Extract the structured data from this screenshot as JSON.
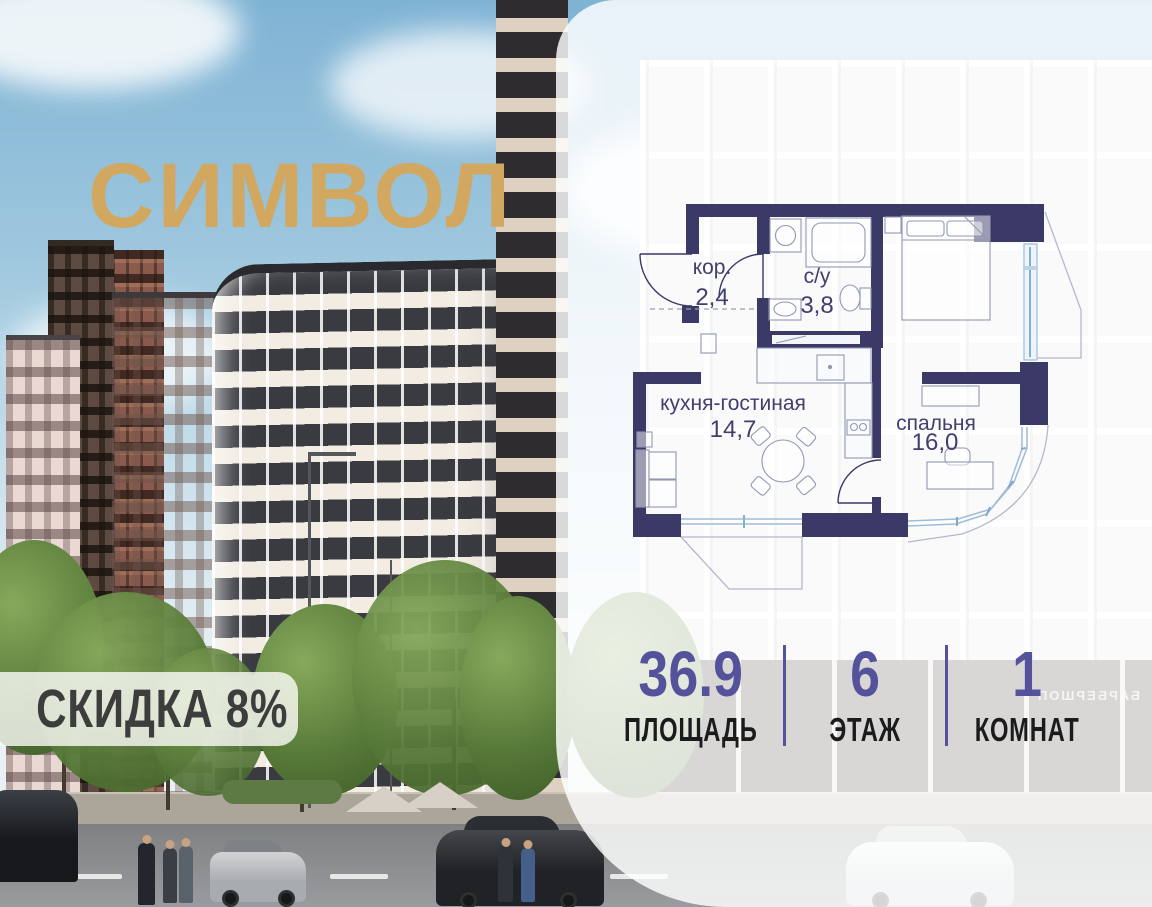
{
  "logo": {
    "text": "СИМВОЛ"
  },
  "badge": {
    "text": "СКИДКА 8%"
  },
  "floorplan": {
    "rooms": [
      {
        "name": "кор.",
        "area": "2,4"
      },
      {
        "name": "с/у",
        "area": "3,8"
      },
      {
        "name": "кухня-гостиная",
        "area": "14,7"
      },
      {
        "name": "спальня",
        "area": "16,0"
      }
    ]
  },
  "stats": {
    "items": [
      {
        "value": "36.9",
        "label": "ПЛОЩАДЬ"
      },
      {
        "value": "6",
        "label": "ЭТАЖ"
      },
      {
        "value": "1",
        "label": "КОМНАТ"
      }
    ]
  },
  "background": {
    "storefront_sign": "БАРБЕРШОП"
  },
  "colors": {
    "accent": "#55529c",
    "plan_walls": "#3b3966",
    "logo_gold": "#d2a75f",
    "window_blue": "#9fbcd6"
  }
}
